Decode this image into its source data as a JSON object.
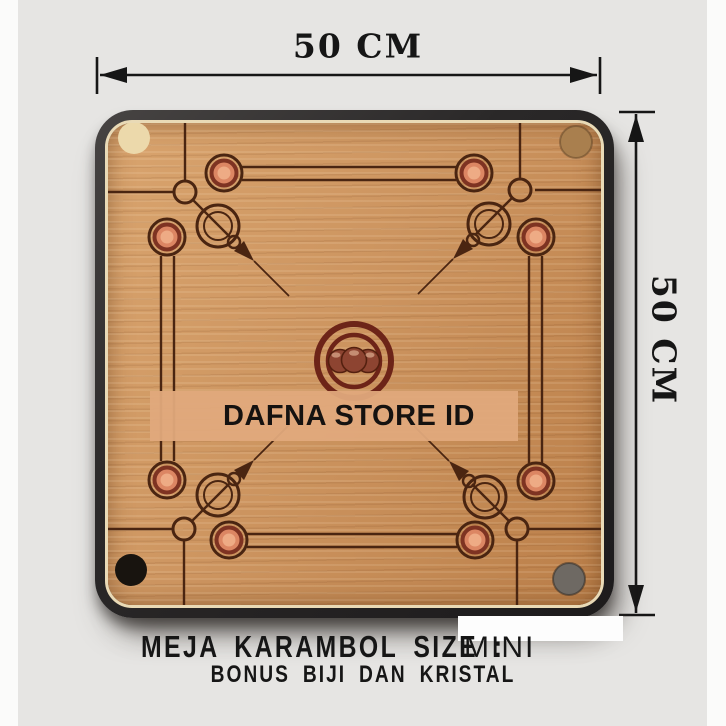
{
  "colors": {
    "bg": "#e6e5e3",
    "strip": "#fbfbfa",
    "ink": "#161616",
    "frame-dark": "#2a2828",
    "frame-light": "#474443",
    "wood-base": "#cd9560",
    "wood-light": "#d9a46e",
    "wood-dark": "#bb7f49",
    "edge-cream": "#e9dab6",
    "line": "#4a2511",
    "ring-red": "#7e3322",
    "ring-fill": "#dc8663",
    "ring-core": "#eeab85",
    "center-ring": "#6d2418",
    "sphere": "#8d4431",
    "sphere-edge": "#54200f",
    "pocket-light": "#ecd9ab",
    "pocket-tan": "#a97f4e",
    "pocket-black": "#18140f",
    "pocket-gray": "#6e6963",
    "band": "#e0a97c",
    "patch": "#fdfdfd"
  },
  "dimensions": {
    "width_label": "50 CM",
    "height_label": "50 CM"
  },
  "watermark": {
    "text": "DAFNA STORE ID"
  },
  "caption": {
    "title": "MEJA KARAMBOL SIZE :",
    "size_value": "MINI",
    "subtitle": "BONUS BIJI DAN KRISTAL"
  }
}
